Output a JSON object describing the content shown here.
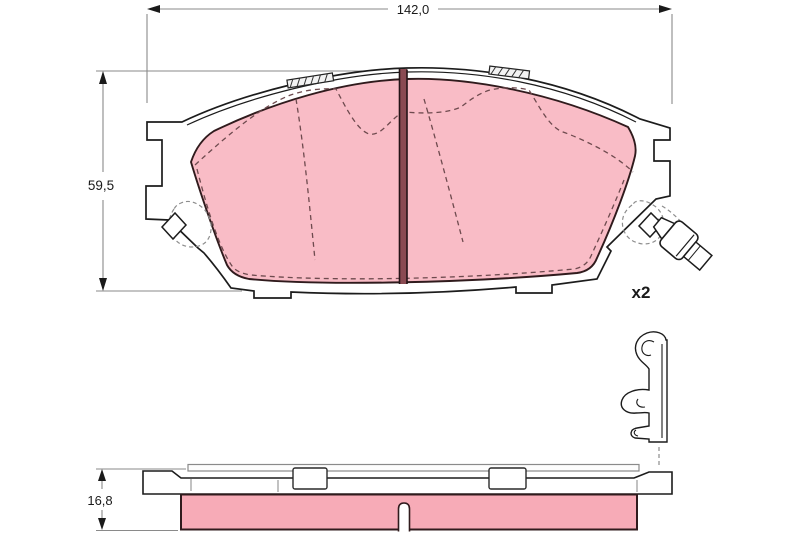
{
  "drawing": {
    "kind": "brake-pad-technical-drawing",
    "dimensions": {
      "width_label": "142,0",
      "height_label": "59,5",
      "thickness_label": "16,8"
    },
    "quantity_label": "x2",
    "colors": {
      "friction_material": "#f9bcc6",
      "friction_strip": "#f7abb7",
      "slot": "#8a4a52",
      "outline": "#1c1c1c",
      "pad_outline": "#301b1d",
      "dimension_line": "#8a8a8a",
      "text": "#1a1a1a",
      "background": "#ffffff",
      "dashed_detail": "#6e4a4e"
    }
  }
}
